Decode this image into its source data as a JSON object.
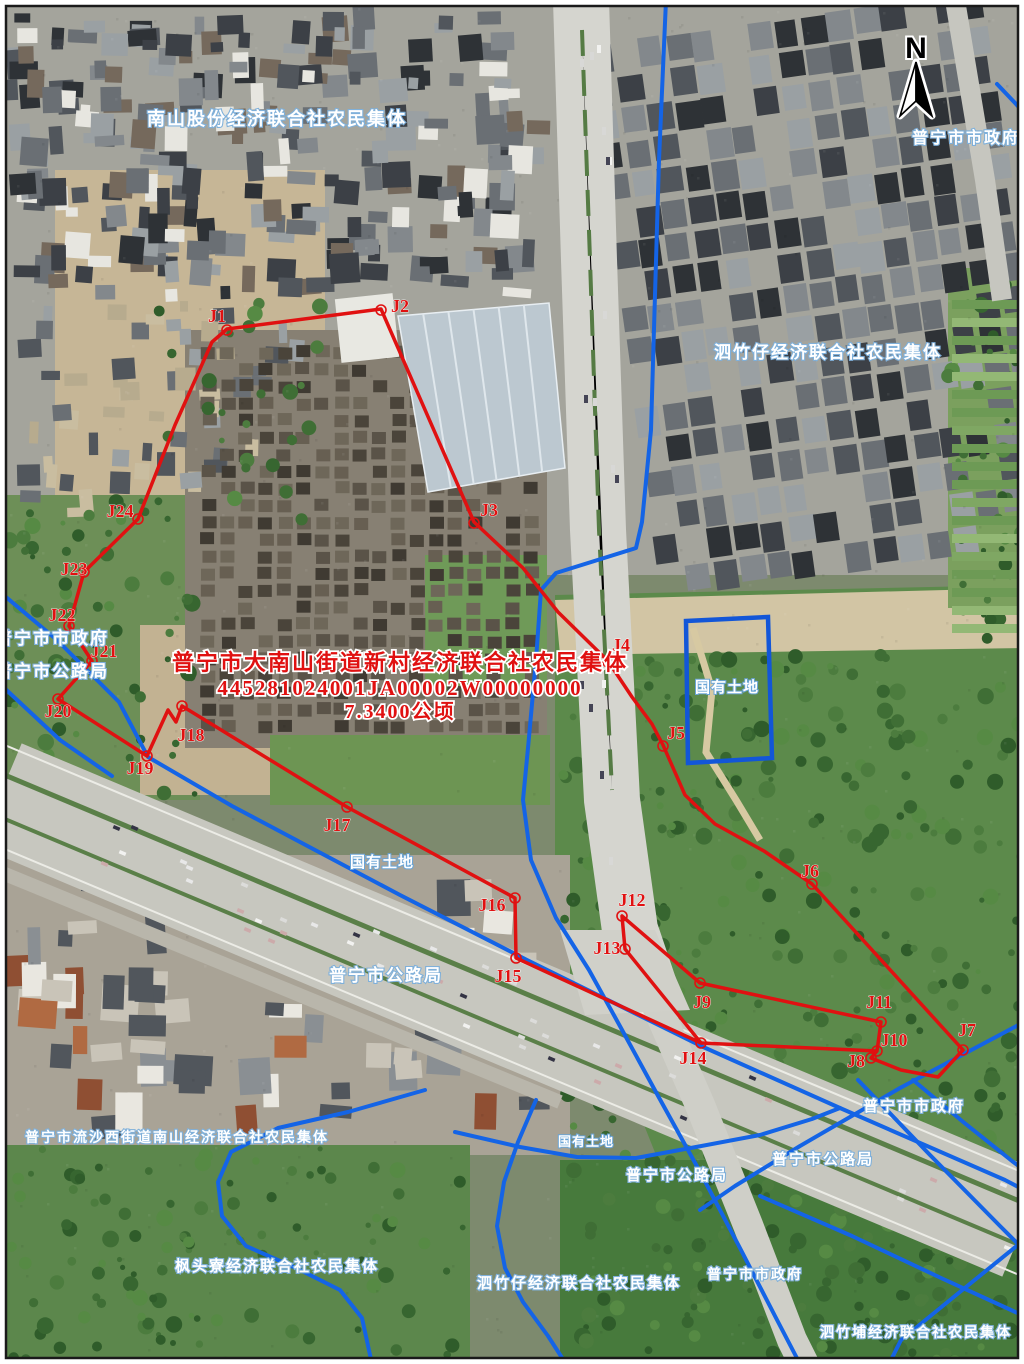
{
  "map": {
    "type": "cadastral-parcel-map",
    "north_label": "N",
    "colors": {
      "parcel_boundary_red": "#e01111",
      "admin_boundary_blue": "#1464e6",
      "state_land_outline_blue": "#1256d8",
      "owner_label_fill": "#ffffff",
      "owner_label_halo": "#7fb0da",
      "annotation_red": "#e01111"
    },
    "annotation": {
      "x": 400,
      "lines": [
        {
          "text": "普宁市大南山街道新村经济联合社农民集体",
          "y": 670,
          "size": 22
        },
        {
          "text": "445281024001JA00002W00000000",
          "y": 695,
          "size": 21
        },
        {
          "text": "7.3400公顷",
          "y": 718,
          "size": 20
        }
      ]
    },
    "owner_labels": [
      {
        "text": "南山股份经济联合社农民集体",
        "x": 277,
        "y": 125,
        "size": 18
      },
      {
        "text": "普宁市市政府",
        "x": 966,
        "y": 143,
        "size": 16
      },
      {
        "text": "泗竹仔经济联合社农民集体",
        "x": 828,
        "y": 358,
        "size": 17
      },
      {
        "text": "普宁市市政府",
        "x": 52,
        "y": 644,
        "size": 17
      },
      {
        "text": "普宁市公路局",
        "x": 52,
        "y": 677,
        "size": 17
      },
      {
        "text": "国有土地",
        "x": 727,
        "y": 692,
        "size": 15
      },
      {
        "text": "国有土地",
        "x": 382,
        "y": 867,
        "size": 15
      },
      {
        "text": "普宁市公路局",
        "x": 386,
        "y": 981,
        "size": 17
      },
      {
        "text": "国有土地",
        "x": 586,
        "y": 1146,
        "size": 13
      },
      {
        "text": "普宁市公路局",
        "x": 677,
        "y": 1180,
        "size": 15
      },
      {
        "text": "普宁市市政府",
        "x": 914,
        "y": 1111,
        "size": 15
      },
      {
        "text": "普宁市公路局",
        "x": 823,
        "y": 1164,
        "size": 15
      },
      {
        "text": "普宁市流沙西街道南山经济联合社农民集体",
        "x": 177,
        "y": 1142,
        "size": 14
      },
      {
        "text": "枫头寮经济联合社农民集体",
        "x": 277,
        "y": 1271,
        "size": 15
      },
      {
        "text": "泗竹仔经济联合社农民集体",
        "x": 579,
        "y": 1288,
        "size": 15
      },
      {
        "text": "普宁市市政府",
        "x": 755,
        "y": 1279,
        "size": 14
      },
      {
        "text": "泗竹埔经济联合社农民集体",
        "x": 916,
        "y": 1337,
        "size": 14
      }
    ],
    "parcel_vertices": [
      {
        "id": "J1",
        "label_x": 217,
        "label_y": 322,
        "cx": 227,
        "cy": 330
      },
      {
        "id": "J2",
        "label_x": 400,
        "label_y": 312,
        "cx": 381,
        "cy": 310
      },
      {
        "id": "J3",
        "label_x": 489,
        "label_y": 516,
        "cx": 474,
        "cy": 523
      },
      {
        "id": "J4",
        "label_x": 621,
        "label_y": 651,
        "cx": 608,
        "cy": 662
      },
      {
        "id": "J5",
        "label_x": 676,
        "label_y": 739,
        "cx": 663,
        "cy": 746
      },
      {
        "id": "J6",
        "label_x": 810,
        "label_y": 877,
        "cx": 812,
        "cy": 884
      },
      {
        "id": "J7",
        "label_x": 967,
        "label_y": 1036,
        "cx": 963,
        "cy": 1050
      },
      {
        "id": "J8",
        "label_x": 856,
        "label_y": 1067,
        "cx": 871,
        "cy": 1058
      },
      {
        "id": "J9",
        "label_x": 702,
        "label_y": 1008,
        "cx": 700,
        "cy": 983
      },
      {
        "id": "J10",
        "label_x": 894,
        "label_y": 1046,
        "cx": 877,
        "cy": 1051
      },
      {
        "id": "J11",
        "label_x": 879,
        "label_y": 1008,
        "cx": 881,
        "cy": 1022
      },
      {
        "id": "J12",
        "label_x": 632,
        "label_y": 906,
        "cx": 622,
        "cy": 916
      },
      {
        "id": "J13",
        "label_x": 607,
        "label_y": 954,
        "cx": 625,
        "cy": 949
      },
      {
        "id": "J14",
        "label_x": 693,
        "label_y": 1064,
        "cx": 701,
        "cy": 1043
      },
      {
        "id": "J15",
        "label_x": 508,
        "label_y": 982,
        "cx": 516,
        "cy": 958
      },
      {
        "id": "J16",
        "label_x": 492,
        "label_y": 911,
        "cx": 515,
        "cy": 898
      },
      {
        "id": "J17",
        "label_x": 337,
        "label_y": 831,
        "cx": 347,
        "cy": 807
      },
      {
        "id": "J18",
        "label_x": 191,
        "label_y": 741,
        "cx": 182,
        "cy": 706
      },
      {
        "id": "J19",
        "label_x": 140,
        "label_y": 774,
        "cx": 147,
        "cy": 756
      },
      {
        "id": "J20",
        "label_x": 58,
        "label_y": 717,
        "cx": 58,
        "cy": 699
      },
      {
        "id": "J21",
        "label_x": 104,
        "label_y": 657,
        "cx": 92,
        "cy": 661
      },
      {
        "id": "J22",
        "label_x": 62,
        "label_y": 621,
        "cx": 69,
        "cy": 626
      },
      {
        "id": "J23",
        "label_x": 74,
        "label_y": 575,
        "cx": 84,
        "cy": 572
      },
      {
        "id": "J24",
        "label_x": 120,
        "label_y": 517,
        "cx": 138,
        "cy": 519
      }
    ],
    "red_boundary": {
      "main_loop": [
        [
          58,
          699
        ],
        [
          92,
          661
        ],
        [
          69,
          626
        ],
        [
          84,
          572
        ],
        [
          138,
          519
        ],
        [
          175,
          425
        ],
        [
          212,
          342
        ],
        [
          227,
          329
        ],
        [
          381,
          309
        ],
        [
          474,
          522
        ],
        [
          523,
          568
        ],
        [
          558,
          612
        ],
        [
          608,
          661
        ],
        [
          632,
          697
        ],
        [
          652,
          724
        ],
        [
          663,
          745
        ],
        [
          685,
          795
        ],
        [
          715,
          824
        ],
        [
          764,
          851
        ],
        [
          812,
          884
        ],
        [
          963,
          1050
        ],
        [
          938,
          1077
        ],
        [
          901,
          1070
        ],
        [
          871,
          1058
        ],
        [
          877,
          1051
        ],
        [
          881,
          1022
        ],
        [
          700,
          983
        ],
        [
          622,
          916
        ],
        [
          625,
          949
        ],
        [
          701,
          1043
        ],
        [
          516,
          958
        ],
        [
          515,
          898
        ],
        [
          347,
          807
        ],
        [
          182,
          706
        ],
        [
          176,
          722
        ],
        [
          168,
          710
        ],
        [
          147,
          756
        ]
      ],
      "extra_segments": [
        [
          [
            701,
            1043
          ],
          [
            877,
            1051
          ]
        ]
      ]
    },
    "state_land_rect": [
      [
        686,
        621
      ],
      [
        768,
        617
      ],
      [
        772,
        758
      ],
      [
        688,
        763
      ]
    ],
    "blue_boundaries": [
      [
        [
          666,
          0
        ],
        [
          659,
          160
        ],
        [
          651,
          430
        ],
        [
          642,
          522
        ],
        [
          636,
          548
        ],
        [
          556,
          573
        ],
        [
          541,
          590
        ],
        [
          536,
          660
        ],
        [
          528,
          748
        ],
        [
          523,
          800
        ],
        [
          531,
          860
        ],
        [
          556,
          918
        ],
        [
          589,
          970
        ],
        [
          621,
          1028
        ],
        [
          657,
          1094
        ],
        [
          699,
          1170
        ],
        [
          741,
          1250
        ],
        [
          775,
          1316
        ],
        [
          800,
          1364
        ]
      ],
      [
        [
          0,
          592
        ],
        [
          57,
          640
        ],
        [
          119,
          702
        ],
        [
          148,
          757
        ],
        [
          232,
          806
        ],
        [
          400,
          895
        ],
        [
          527,
          960
        ],
        [
          701,
          1046
        ],
        [
          840,
          1108
        ],
        [
          1005,
          1180
        ],
        [
          1024,
          1190
        ]
      ],
      [
        [
          0,
          684
        ],
        [
          60,
          740
        ],
        [
          112,
          776
        ]
      ],
      [
        [
          425,
          1090
        ],
        [
          348,
          1112
        ],
        [
          278,
          1128
        ],
        [
          231,
          1152
        ],
        [
          218,
          1182
        ],
        [
          222,
          1216
        ],
        [
          246,
          1246
        ],
        [
          296,
          1268
        ],
        [
          340,
          1290
        ],
        [
          362,
          1318
        ],
        [
          372,
          1364
        ]
      ],
      [
        [
          536,
          1100
        ],
        [
          518,
          1142
        ],
        [
          504,
          1182
        ],
        [
          497,
          1226
        ],
        [
          505,
          1268
        ],
        [
          523,
          1302
        ],
        [
          548,
          1336
        ],
        [
          566,
          1364
        ]
      ],
      [
        [
          455,
          1132
        ],
        [
          520,
          1147
        ],
        [
          577,
          1157
        ],
        [
          636,
          1158
        ],
        [
          696,
          1147
        ],
        [
          760,
          1135
        ],
        [
          812,
          1119
        ],
        [
          840,
          1108
        ]
      ],
      [
        [
          1024,
          1022
        ],
        [
          900,
          1088
        ],
        [
          800,
          1146
        ],
        [
          735,
          1186
        ],
        [
          700,
          1210
        ]
      ],
      [
        [
          913,
          1080
        ],
        [
          962,
          1121
        ],
        [
          1012,
          1161
        ],
        [
          1024,
          1170
        ]
      ],
      [
        [
          760,
          1196
        ],
        [
          852,
          1236
        ],
        [
          941,
          1278
        ],
        [
          1011,
          1310
        ],
        [
          1024,
          1316
        ]
      ],
      [
        [
          1024,
          1240
        ],
        [
          950,
          1300
        ],
        [
          901,
          1340
        ],
        [
          889,
          1364
        ]
      ],
      [
        [
          858,
          1080
        ],
        [
          930,
          1155
        ],
        [
          1000,
          1226
        ],
        [
          1024,
          1250
        ]
      ],
      [
        [
          997,
          84
        ],
        [
          1016,
          104
        ],
        [
          1024,
          113
        ]
      ]
    ]
  }
}
